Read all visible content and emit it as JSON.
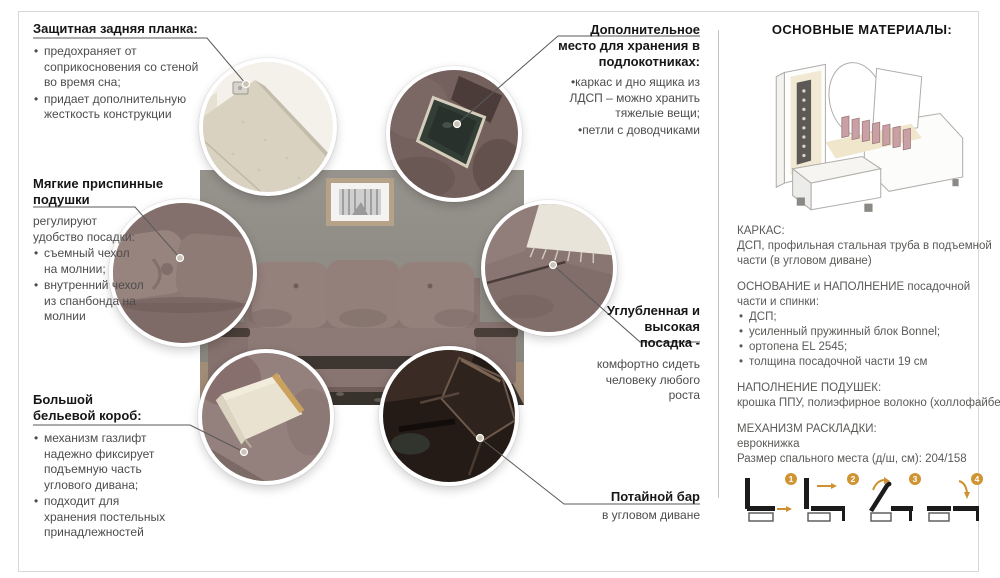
{
  "colors": {
    "accent_orange": "#d09433",
    "sofa_mauve": "#8d7975",
    "leader_line": "#5a5a58",
    "panel_text": "#5a5a58",
    "border_gray": "#d8d8d6"
  },
  "callouts": {
    "back_plank": {
      "title": "Защитная задняя планка:",
      "bullets": [
        "предохраняет от соприкосновения со стеной во время сна;",
        "придает дополнительную жесткость конструкции"
      ]
    },
    "back_cushions": {
      "title": "Мягкие приспинные подушки",
      "lead": "регулируют удобство посадки:",
      "bullets": [
        "съемный чехол на молнии;",
        "внутренний чехол из спанбонда на молнии"
      ]
    },
    "linen_box": {
      "title": "Большой бельевой короб:",
      "bullets": [
        "механизм газлифт надежно фиксирует подъемную часть углового дивана;",
        "подходит для хранения постельных принадлежностей"
      ]
    },
    "armrest_storage": {
      "title": "Дополнительное место для хранения в подлокотниках:",
      "bullets": [
        "каркас и дно ящика из ЛДСП – можно хранить тяжелые вещи;",
        "петли с доводчиками"
      ]
    },
    "deep_seat": {
      "title": "Углубленная и высокая посадка -",
      "text": "комфортно сидеть человеку любого роста"
    },
    "hidden_bar": {
      "title": "Потайной бар",
      "text": "в угловом диване"
    }
  },
  "materials": {
    "title": "ОСНОВНЫЕ МАТЕРИАЛЫ:",
    "frame": {
      "label": "КАРКАС:",
      "lines": [
        "ДСП, профильная стальная труба в подъемной",
        "части (в угловом диване)"
      ]
    },
    "base": {
      "label_lines": [
        "ОСНОВАНИЕ и НАПОЛНЕНИЕ посадочной",
        "части и спинки:"
      ],
      "bullets": [
        "ДСП;",
        "усиленный пружинный блок Bonnel;",
        "ортопена EL 2545;",
        "толщина посадочной части 19 см"
      ]
    },
    "cushion_fill": {
      "label": "НАПОЛНЕНИЕ ПОДУШЕК:",
      "text": "крошка ППУ, полиэфирное волокно (холлофайбер)"
    },
    "mechanism": {
      "label": "МЕХАНИЗМ РАСКЛАДКИ:",
      "lines": [
        "еврокнижка",
        "Размер спального места (д/ш, см): 204/158"
      ]
    },
    "steps": [
      "1",
      "2",
      "3",
      "4"
    ]
  }
}
